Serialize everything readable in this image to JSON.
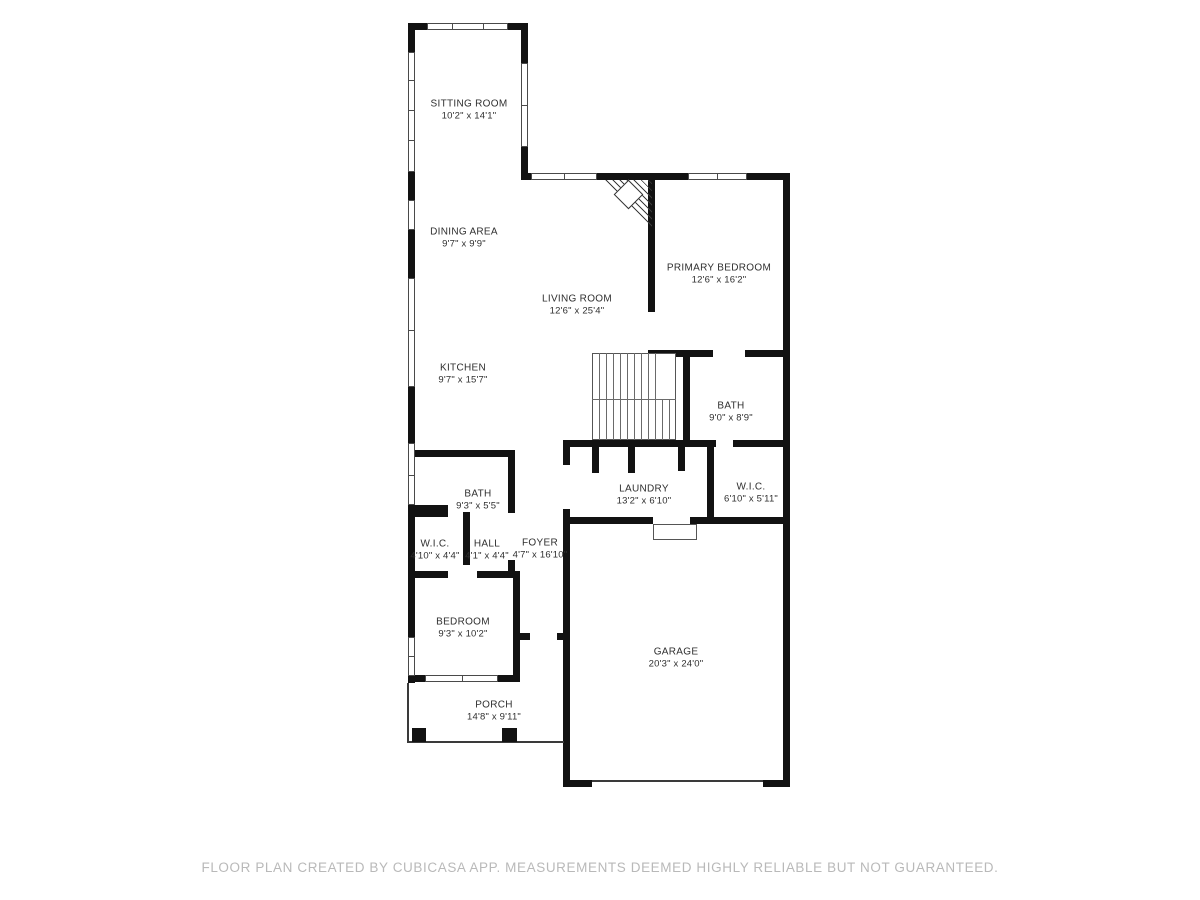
{
  "rooms": {
    "sitting": {
      "name": "SITTING ROOM",
      "dims": "10'2\" x 14'1\""
    },
    "dining": {
      "name": "DINING AREA",
      "dims": "9'7\" x 9'9\""
    },
    "living": {
      "name": "LIVING ROOM",
      "dims": "12'6\" x 25'4\""
    },
    "primary": {
      "name": "PRIMARY BEDROOM",
      "dims": "12'6\" x 16'2\""
    },
    "kitchen": {
      "name": "KITCHEN",
      "dims": "9'7\" x 15'7\""
    },
    "bath_up": {
      "name": "BATH",
      "dims": "9'0\" x 8'9\""
    },
    "laundry": {
      "name": "LAUNDRY",
      "dims": "13'2\" x 6'10\""
    },
    "wic_right": {
      "name": "W.I.C.",
      "dims": "6'10\" x 5'11\""
    },
    "bath_low": {
      "name": "BATH",
      "dims": "9'3\" x 5'5\""
    },
    "wic_left": {
      "name": "W.I.C.",
      "dims": "4'10\" x 4'4\""
    },
    "hall": {
      "name": "HALL",
      "dims": "4'1\" x 4'4\""
    },
    "foyer": {
      "name": "FOYER",
      "dims": "4'7\" x 16'10\""
    },
    "bedroom": {
      "name": "BEDROOM",
      "dims": "9'3\" x 10'2\""
    },
    "garage": {
      "name": "GARAGE",
      "dims": "20'3\" x 24'0\""
    },
    "porch": {
      "name": "PORCH",
      "dims": "14'8\" x 9'11\""
    }
  },
  "footer": {
    "text": "FLOOR PLAN CREATED BY CUBICASA APP. MEASUREMENTS DEEMED HIGHLY RELIABLE BUT NOT GUARANTEED."
  },
  "colors": {
    "wall": "#121212",
    "label_text": "#2f2f2f",
    "footer_text": "#b9b9b9"
  }
}
